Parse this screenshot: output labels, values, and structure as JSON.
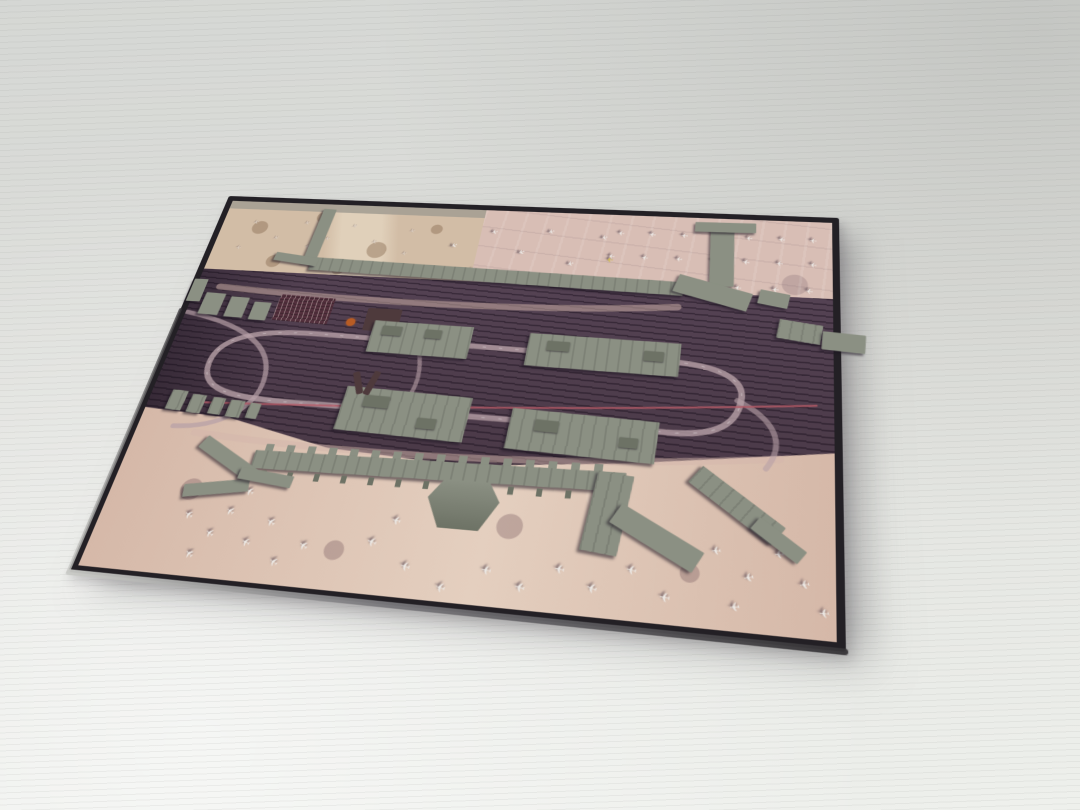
{
  "scene": {
    "description": "Photograph of a black-edged display board holding an aerial satellite map of a large airport with 3D-printed gray terminal, concourse and parking-garage models glued on top; dozens of white parked aircraft are printed on the pink-tan aprons; the board lies at an angle on a white corrugated surface."
  },
  "colors": {
    "bg_top": "#d5d7d4",
    "bg_mid": "#dedfdb",
    "bg_bottom": "#eef0ec",
    "ridge": "rgba(125,128,124,0.09)",
    "frame_dark": "#232025",
    "frame_edge_light": "#c9cac6",
    "frame_edge_mid": "#77767a",
    "apron_tan": "#d2bda6",
    "apron_tan_light": "#e0d0ba",
    "apron_mottle": "rgba(137,108,82,0.45)",
    "apron_pink": "#d8beb5",
    "band_top": "#544253",
    "band_bottom": "#4a3947",
    "band_streak": "rgba(25,15,28,0.45)",
    "road_light": "#b7a0a6",
    "road_pale": "#d3b5ac",
    "road_dash": "#d8cfd2",
    "rail_red": "#b45a66",
    "apron_bottom": "#d5b8a8",
    "apron_bottom_light": "#e4cfbf",
    "apron_bottom_mottle": "rgba(120,90,95,0.35)",
    "model": "#8b9083",
    "model_dark": "#6d7265",
    "model_shadow": "rgba(28,20,32,0.55)",
    "lot": "#53303d",
    "lot_grid": "rgba(220,205,200,0.5)",
    "orange": "#b85c24",
    "plane": "#edeae6",
    "plane_faint": "#ddd2c8",
    "plane_shadow": "rgba(58,44,60,0.65)",
    "plane_yellow": "#d2bc55",
    "dark_blob": "#4e3a3c"
  },
  "plaque": {
    "w": 776,
    "h": 516,
    "corners": {
      "tl": [
        229,
        196
      ],
      "tr": [
        839,
        218
      ],
      "br": [
        846,
        652
      ],
      "bl": [
        68,
        572
      ]
    }
  },
  "model": {
    "plane_glyph": "✈",
    "buildings": [
      {
        "n": "upper-terminal-main",
        "x": 135,
        "y": 92,
        "w": 458,
        "h": 20,
        "r": 1.5,
        "cls": "roof"
      },
      {
        "n": "upper-terminal-north-pier",
        "x": 126,
        "y": 8,
        "w": 17,
        "h": 88,
        "r": 3,
        "cls": ""
      },
      {
        "n": "upper-terminal-west-wing",
        "x": 86,
        "y": 84,
        "w": 58,
        "h": 13,
        "r": 7,
        "cls": ""
      },
      {
        "n": "upper-terminal-east-pier",
        "x": 620,
        "y": 10,
        "w": 28,
        "h": 92,
        "r": -2,
        "cls": ""
      },
      {
        "n": "upper-terminal-east-pier-head",
        "x": 600,
        "y": 6,
        "w": 72,
        "h": 15,
        "r": -1,
        "cls": ""
      },
      {
        "n": "upper-terminal-east-wedge",
        "x": 582,
        "y": 98,
        "w": 88,
        "h": 26,
        "r": 16,
        "cls": ""
      },
      {
        "n": "east-block-a",
        "x": 678,
        "y": 106,
        "w": 34,
        "h": 20,
        "r": 10,
        "cls": ""
      },
      {
        "n": "east-block-b",
        "x": 700,
        "y": 146,
        "w": 48,
        "h": 26,
        "r": 8,
        "cls": "roof"
      },
      {
        "n": "east-edge-protrusion",
        "x": 748,
        "y": 158,
        "w": 46,
        "h": 24,
        "r": 4,
        "cls": ""
      },
      {
        "n": "west-edge-block",
        "x": -6,
        "y": 128,
        "w": 18,
        "h": 34,
        "r": 0,
        "cls": ""
      },
      {
        "n": "west-block-a",
        "x": 16,
        "y": 148,
        "w": 26,
        "h": 32,
        "r": 2,
        "cls": ""
      },
      {
        "n": "west-block-b",
        "x": 50,
        "y": 152,
        "w": 24,
        "h": 30,
        "r": 2,
        "cls": ""
      },
      {
        "n": "west-block-c",
        "x": 82,
        "y": 158,
        "w": 22,
        "h": 26,
        "r": 2,
        "cls": ""
      },
      {
        "n": "parking-lot-maroon",
        "x": 112,
        "y": 146,
        "w": 70,
        "h": 38,
        "r": 2,
        "cls": "lot"
      },
      {
        "n": "dark-structure",
        "x": 226,
        "y": 158,
        "w": 42,
        "h": 32,
        "r": 0,
        "cls": "blob"
      },
      {
        "n": "orange-structure",
        "x": 204,
        "y": 174,
        "w": 11,
        "h": 11,
        "r": 0,
        "cls": "orange"
      },
      {
        "n": "garage-northwest",
        "x": 238,
        "y": 176,
        "w": 120,
        "h": 44,
        "r": 1,
        "cls": "roof"
      },
      {
        "n": "garage-northeast",
        "x": 424,
        "y": 182,
        "w": 172,
        "h": 44,
        "r": 1,
        "cls": "roof"
      },
      {
        "n": "garage-southwest",
        "x": 228,
        "y": 268,
        "w": 146,
        "h": 56,
        "r": 2,
        "cls": "roof"
      },
      {
        "n": "garage-southeast",
        "x": 420,
        "y": 282,
        "w": 160,
        "h": 50,
        "r": 2,
        "cls": "roof"
      },
      {
        "n": "rooftop-unit",
        "x": 250,
        "y": 182,
        "w": 24,
        "h": 13,
        "r": 1,
        "cls": "dark"
      },
      {
        "n": "rooftop-unit",
        "x": 302,
        "y": 184,
        "w": 20,
        "h": 12,
        "r": 1,
        "cls": "dark"
      },
      {
        "n": "rooftop-unit",
        "x": 446,
        "y": 190,
        "w": 26,
        "h": 13,
        "r": 1,
        "cls": "dark"
      },
      {
        "n": "rooftop-unit",
        "x": 556,
        "y": 196,
        "w": 22,
        "h": 13,
        "r": 1,
        "cls": "dark"
      },
      {
        "n": "rooftop-unit",
        "x": 252,
        "y": 276,
        "w": 30,
        "h": 15,
        "r": 2,
        "cls": "dark"
      },
      {
        "n": "rooftop-unit",
        "x": 318,
        "y": 300,
        "w": 22,
        "h": 13,
        "r": 2,
        "cls": "dark"
      },
      {
        "n": "rooftop-unit",
        "x": 448,
        "y": 292,
        "w": 26,
        "h": 14,
        "r": 2,
        "cls": "dark"
      },
      {
        "n": "rooftop-unit",
        "x": 540,
        "y": 306,
        "w": 20,
        "h": 12,
        "r": 2,
        "cls": "dark"
      },
      {
        "n": "support-building",
        "x": 24,
        "y": 286,
        "w": 20,
        "h": 26,
        "r": 3,
        "cls": "roof"
      },
      {
        "n": "support-building",
        "x": 50,
        "y": 290,
        "w": 18,
        "h": 24,
        "r": 3,
        "cls": "roof"
      },
      {
        "n": "support-building",
        "x": 76,
        "y": 292,
        "w": 16,
        "h": 22,
        "r": 3,
        "cls": "roof"
      },
      {
        "n": "support-building",
        "x": 98,
        "y": 294,
        "w": 18,
        "h": 22,
        "r": 3,
        "cls": "roof"
      },
      {
        "n": "support-building",
        "x": 122,
        "y": 296,
        "w": 14,
        "h": 20,
        "r": 3,
        "cls": "roof"
      },
      {
        "n": "dark-v-mark-left",
        "x": 236,
        "y": 246,
        "w": 8,
        "h": 30,
        "r": -22,
        "cls": "blob"
      },
      {
        "n": "dark-v-mark-right",
        "x": 252,
        "y": 244,
        "w": 8,
        "h": 32,
        "r": 14,
        "cls": "blob"
      },
      {
        "n": "lower-terminal-gates-north",
        "x": 158,
        "y": 342,
        "w": 376,
        "h": 9,
        "r": -1,
        "cls": "teeth"
      },
      {
        "n": "lower-terminal-main",
        "x": 148,
        "y": 350,
        "w": 404,
        "h": 22,
        "r": -1,
        "cls": "roof"
      },
      {
        "n": "lower-terminal-gates-south",
        "x": 162,
        "y": 374,
        "w": 368,
        "h": 9,
        "r": -1,
        "cls": "teeth2"
      },
      {
        "n": "lower-terminal-rotunda",
        "x": 350,
        "y": 370,
        "w": 76,
        "h": 54,
        "r": 0,
        "cls": "dome"
      },
      {
        "n": "lower-terminal-west-pier-a",
        "x": 80,
        "y": 358,
        "w": 80,
        "h": 17,
        "r": 28,
        "cls": ""
      },
      {
        "n": "lower-terminal-west-pier-b",
        "x": 82,
        "y": 394,
        "w": 72,
        "h": 15,
        "r": -10,
        "cls": ""
      },
      {
        "n": "lower-terminal-west-link",
        "x": 138,
        "y": 378,
        "w": 62,
        "h": 14,
        "r": 6,
        "cls": ""
      },
      {
        "n": "lower-terminal-east-pier",
        "x": 518,
        "y": 348,
        "w": 38,
        "h": 88,
        "r": 6,
        "cls": "roof"
      },
      {
        "n": "lower-terminal-east-wedge",
        "x": 540,
        "y": 402,
        "w": 96,
        "h": 24,
        "r": 28,
        "cls": ""
      },
      {
        "n": "lower-terminal-far-east-pier",
        "x": 612,
        "y": 360,
        "w": 104,
        "h": 24,
        "r": 36,
        "cls": "roof"
      },
      {
        "n": "lower-terminal-far-east-finger",
        "x": 678,
        "y": 398,
        "w": 56,
        "h": 16,
        "r": 36,
        "cls": ""
      }
    ],
    "planes": [
      [
        40,
        28,
        165,
        9,
        "f"
      ],
      [
        74,
        52,
        150,
        9,
        "f"
      ],
      [
        30,
        70,
        175,
        9,
        "f"
      ],
      [
        108,
        26,
        155,
        9,
        "f"
      ],
      [
        142,
        50,
        168,
        9,
        "f"
      ],
      [
        96,
        86,
        160,
        9,
        "f"
      ],
      [
        172,
        28,
        150,
        9,
        "f"
      ],
      [
        204,
        52,
        162,
        9,
        "f"
      ],
      [
        152,
        90,
        172,
        9,
        "f"
      ],
      [
        216,
        86,
        155,
        9,
        "f"
      ],
      [
        248,
        32,
        158,
        9,
        "f"
      ],
      [
        246,
        68,
        165,
        9,
        "f"
      ],
      [
        120,
        64,
        178,
        9,
        "f"
      ],
      [
        305,
        52,
        150,
        10,
        "s"
      ],
      [
        336,
        88,
        160,
        10,
        "s"
      ],
      [
        352,
        28,
        165,
        10,
        "s"
      ],
      [
        390,
        58,
        152,
        10,
        "s"
      ],
      [
        422,
        24,
        158,
        10,
        "s"
      ],
      [
        452,
        72,
        160,
        10,
        "s"
      ],
      [
        382,
        94,
        150,
        10,
        "s"
      ],
      [
        488,
        30,
        162,
        10,
        "s"
      ],
      [
        498,
        64,
        180,
        11,
        "y"
      ],
      [
        508,
        22,
        185,
        10,
        "s"
      ],
      [
        546,
        22,
        190,
        10,
        "s"
      ],
      [
        584,
        22,
        183,
        10,
        "s"
      ],
      [
        622,
        22,
        187,
        10,
        "s"
      ],
      [
        660,
        22,
        184,
        10,
        "s"
      ],
      [
        698,
        22,
        189,
        10,
        "s"
      ],
      [
        734,
        22,
        185,
        10,
        "s"
      ],
      [
        500,
        58,
        184,
        10,
        "s"
      ],
      [
        540,
        58,
        188,
        10,
        "s"
      ],
      [
        580,
        58,
        183,
        10,
        "s"
      ],
      [
        620,
        58,
        186,
        10,
        "s"
      ],
      [
        658,
        58,
        190,
        10,
        "s"
      ],
      [
        696,
        58,
        184,
        10,
        "s"
      ],
      [
        734,
        58,
        187,
        10,
        "s"
      ],
      [
        524,
        96,
        186,
        10,
        "s"
      ],
      [
        566,
        96,
        182,
        10,
        "s"
      ],
      [
        608,
        96,
        189,
        10,
        "s"
      ],
      [
        650,
        96,
        185,
        10,
        "s"
      ],
      [
        692,
        96,
        183,
        10,
        "s"
      ],
      [
        730,
        96,
        188,
        10,
        "s"
      ],
      [
        152,
        396,
        205,
        12,
        "b"
      ],
      [
        138,
        420,
        212,
        12,
        "b"
      ],
      [
        124,
        446,
        208,
        12,
        "b"
      ],
      [
        110,
        470,
        215,
        12,
        "b"
      ],
      [
        166,
        452,
        200,
        12,
        "b"
      ],
      [
        186,
        428,
        210,
        12,
        "b"
      ],
      [
        94,
        428,
        205,
        12,
        "b"
      ],
      [
        202,
        470,
        206,
        12,
        "b"
      ],
      [
        228,
        450,
        210,
        12,
        "b"
      ],
      [
        298,
        438,
        195,
        13,
        "b"
      ],
      [
        338,
        460,
        188,
        13,
        "b"
      ],
      [
        378,
        478,
        192,
        13,
        "b"
      ],
      [
        420,
        456,
        185,
        13,
        "b"
      ],
      [
        456,
        470,
        190,
        13,
        "b"
      ],
      [
        492,
        448,
        186,
        13,
        "b"
      ],
      [
        526,
        464,
        193,
        13,
        "b"
      ],
      [
        562,
        442,
        188,
        13,
        "b"
      ],
      [
        318,
        414,
        190,
        12,
        "b"
      ],
      [
        596,
        466,
        185,
        13,
        "b"
      ],
      [
        642,
        416,
        172,
        12,
        "b"
      ],
      [
        674,
        440,
        166,
        12,
        "b"
      ],
      [
        702,
        414,
        173,
        12,
        "b"
      ],
      [
        726,
        442,
        168,
        12,
        "b"
      ],
      [
        744,
        468,
        175,
        12,
        "b"
      ],
      [
        662,
        470,
        170,
        12,
        "b"
      ]
    ]
  },
  "roads": {
    "paths": [
      {
        "n": "upper-frontage-road",
        "d": "M30,138 C200,150 420,152 588,134",
        "c": "road_pale",
        "w": 9,
        "o": 0.5
      },
      {
        "n": "terminal-loop-road",
        "d": "M55,248 C55,206 110,197 180,199 L585,208 C645,210 668,228 664,252 C660,288 630,298 585,296 L190,292 C115,292 55,290 55,248 Z",
        "c": "road_light",
        "w": 7,
        "o": 0.8
      },
      {
        "n": "loop-centerline",
        "d": "M55,248 C55,206 110,197 180,199 L585,208 C645,210 668,228 664,252 C660,288 630,298 585,296 L190,292 C115,292 55,290 55,248 Z",
        "c": "road_dash",
        "w": 1.2,
        "o": 0.55,
        "dash": "3 16"
      },
      {
        "n": "west-ramp",
        "d": "M2,178 C70,190 122,214 128,258 C134,300 100,330 42,332",
        "c": "road_light",
        "w": 6,
        "o": 0.7
      },
      {
        "n": "center-ramp",
        "d": "M300,212 C310,242 310,262 296,292",
        "c": "road_light",
        "w": 5,
        "o": 0.6
      },
      {
        "n": "lower-frontage-road",
        "d": "M70,338 C260,352 480,346 706,318",
        "c": "road_pale",
        "w": 8,
        "o": 0.5
      },
      {
        "n": "east-ramp",
        "d": "M660,252 C700,272 712,300 692,330",
        "c": "road_light",
        "w": 6,
        "o": 0.6
      },
      {
        "n": "transit-line",
        "d": "M60,300 C260,292 480,278 742,252",
        "c": "rail_red",
        "w": 2.5,
        "o": 0.8
      }
    ]
  }
}
